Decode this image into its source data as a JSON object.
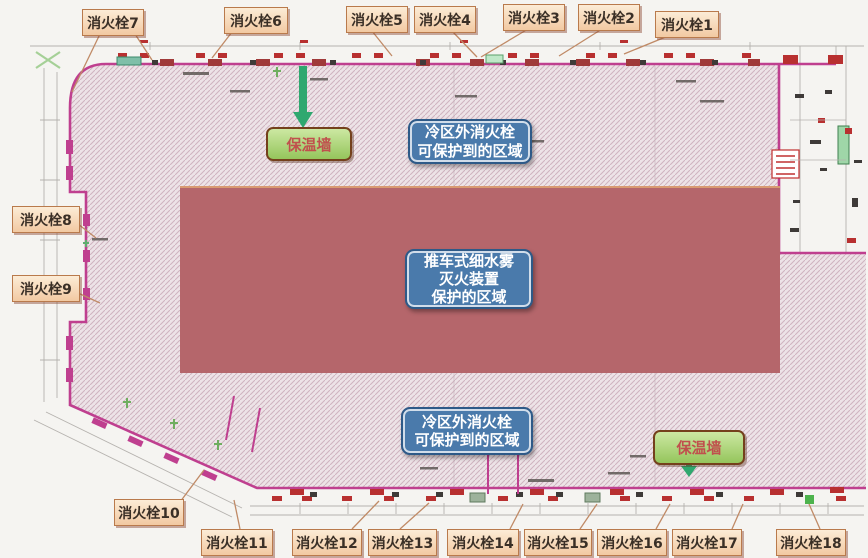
{
  "title": "消火栓布置图",
  "hydrants": [
    "消火栓1",
    "消火栓2",
    "消火栓3",
    "消火栓4",
    "消火栓5",
    "消火栓6",
    "消火栓7",
    "消火栓8",
    "消火栓9",
    "消火栓10",
    "消火栓11",
    "消火栓12",
    "消火栓13",
    "消火栓14",
    "消火栓15",
    "消火栓16",
    "消火栓17",
    "消火栓18"
  ],
  "walls": {
    "top": "保温墙",
    "bottom": "保温墙"
  },
  "zones": {
    "cold_top": "冷区外消火栓\n可保护到的区域",
    "cart": "推车式细水雾\n灭火装置\n保护的区域",
    "cold_bottom": "冷区外消火栓\n可保护到的区域"
  },
  "colors": {
    "hatch_background": "#ede3e7",
    "hatch_line": "#cfb3bf",
    "boundary_magenta": "#bf3f8f",
    "protection_zone_fill": "#b5666b",
    "hydrant_tag_background": "#f6d6b0",
    "hydrant_tag_border": "#b97a4c",
    "zone_tag_blue": "#4a7aab",
    "wall_tag_green": "#a8d36e",
    "wall_tag_text_red": "#c0504d",
    "arrow_green": "#2fa86f",
    "leader_tan": "#c08a66",
    "marker_red": "#b83030"
  }
}
